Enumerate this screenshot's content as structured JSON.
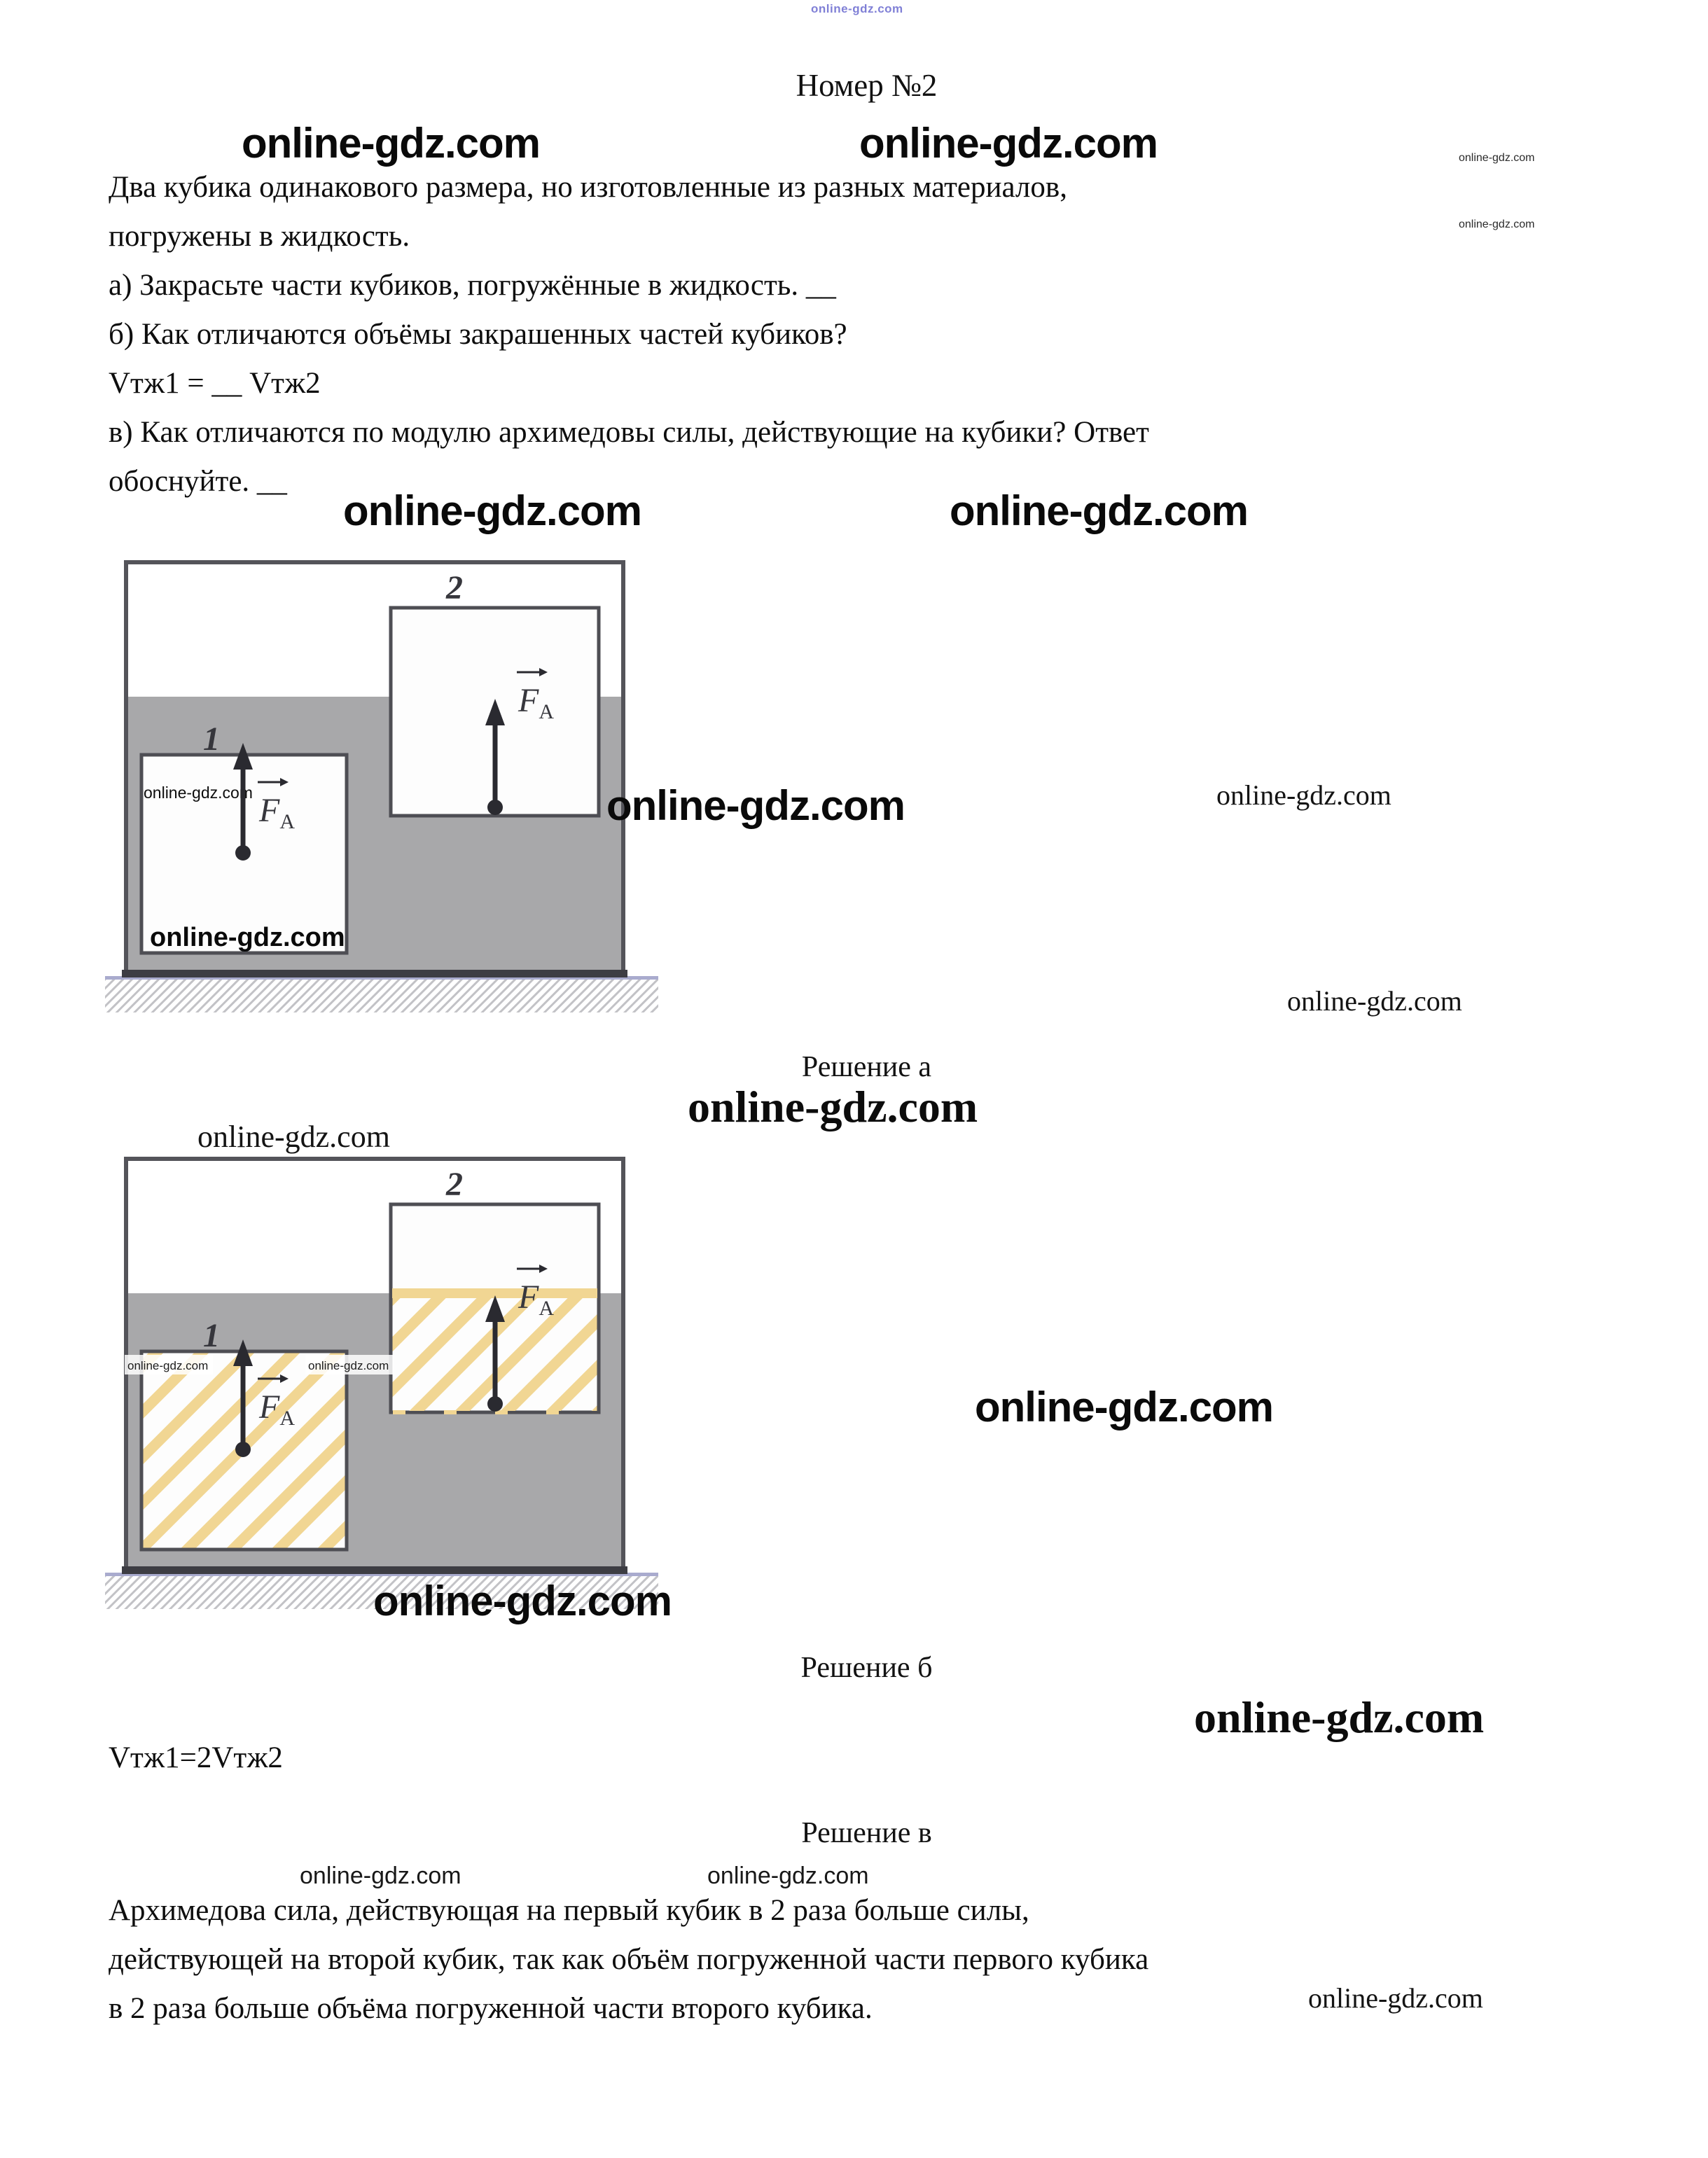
{
  "page": {
    "title": "Номер №2"
  },
  "watermark": {
    "text": "online-gdz.com"
  },
  "problem": {
    "lines": [
      "Два кубика одинакового размера, но изготовленные из разных материалов,",
      "погружены в жидкость.",
      "а) Закрасьте части кубиков, погружённые в жидкость. __",
      "б) Как отличаются объёмы закрашенных частей кубиков?",
      "Vтж1 = __ Vтж2",
      "в) Как отличаются по модулю архимедовы силы, действующие на кубики? Ответ",
      "обоснуйте. __"
    ]
  },
  "solution_a": {
    "caption": "Решение а"
  },
  "solution_b": {
    "caption": "Решение б",
    "answer": "Vтж1=2Vтж2"
  },
  "solution_v": {
    "caption": "Решение в",
    "lines": [
      "Архимедова сила, действующая на первый кубик в 2 раза больше силы,",
      "действующей на второй кубик, так как объём погруженной части первого кубика",
      "в 2 раза больше объёма погруженной части второго кубика."
    ]
  },
  "diagram": {
    "cube1_label": "1",
    "cube2_label": "2",
    "force_label": "F",
    "force_sub": "A",
    "colors": {
      "liquid": "#a8a8aa",
      "hatch": "#f1d693",
      "border": "#4e4e54",
      "tank_border": "#54545a",
      "tank_bottom": "#3d3d43",
      "arrow": "#2a2a30",
      "ground_line": "#c2c2c6",
      "lavender": "#a9abce"
    }
  }
}
